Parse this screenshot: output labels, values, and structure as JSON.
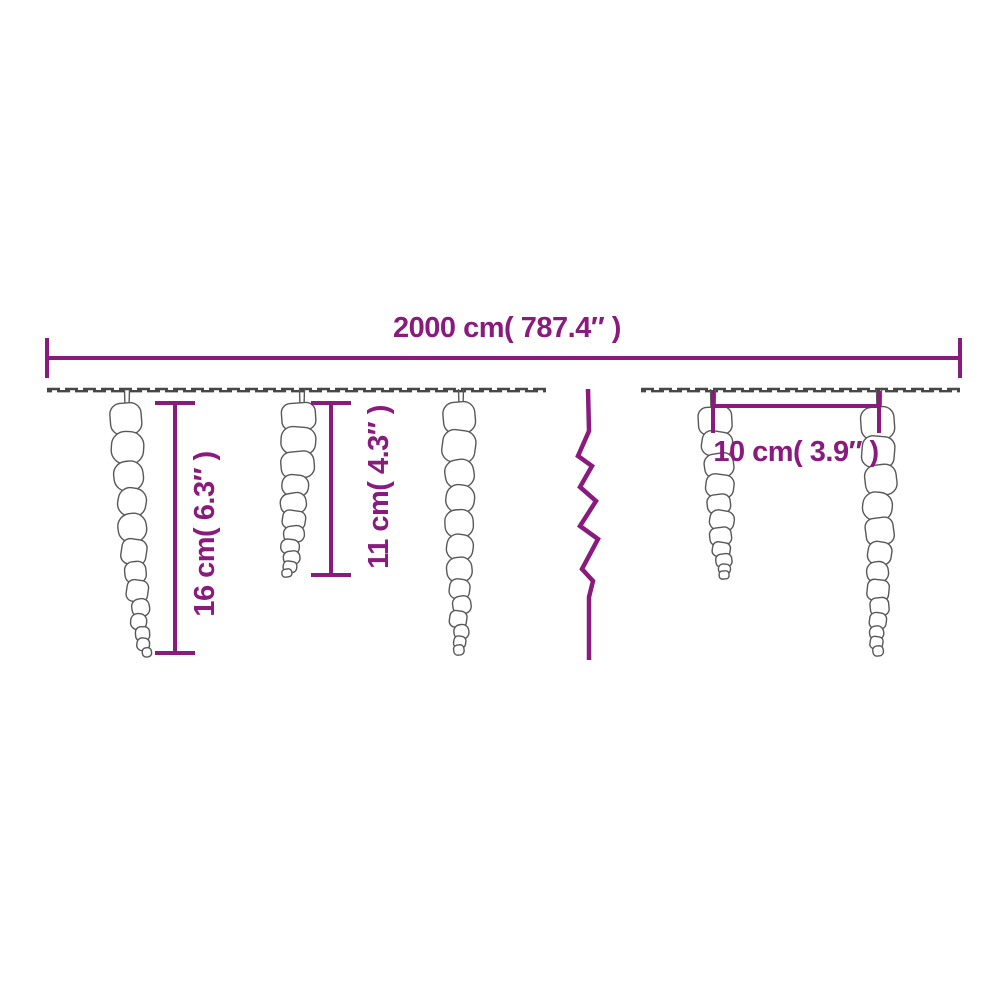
{
  "page": {
    "background": "#ffffff",
    "description": "Product dimension diagram of icicle string lights"
  },
  "colors": {
    "dimension": "#8a1a7d",
    "wire": "#474747",
    "icicle_outline": "#585858",
    "icicle_fill": "#ffffff"
  },
  "labels": {
    "total_width": "2000 cm( 787.4″ )",
    "height_large": "16 cm( 6.3″ )",
    "height_small": "11 cm( 4.3″ )",
    "spacing": "10 cm( 3.9″ )"
  },
  "diagram": {
    "canvas": {
      "width": 1000,
      "height": 1000
    },
    "top_dimension": {
      "x1": 47,
      "x2": 960,
      "y": 358,
      "tick_half": 20,
      "label_anchor": [
        507,
        337
      ]
    },
    "wire": {
      "y": 390,
      "segments": [
        [
          47,
          546
        ],
        [
          641,
          960
        ]
      ]
    },
    "break_line": {
      "points": [
        [
          588,
          389
        ],
        [
          589,
          431
        ],
        [
          578,
          456
        ],
        [
          592,
          466
        ],
        [
          580,
          487
        ],
        [
          596,
          501
        ],
        [
          580,
          526
        ],
        [
          598,
          539
        ],
        [
          582,
          569
        ],
        [
          593,
          581
        ],
        [
          589,
          597
        ],
        [
          589,
          660
        ]
      ]
    },
    "vertical_dimensions": [
      {
        "key": "height_large",
        "x": 175,
        "y1": 403,
        "y2": 653,
        "tick_half": 20,
        "label_anchor": [
          214,
          534
        ]
      },
      {
        "key": "height_small",
        "x": 331,
        "y1": 403,
        "y2": 575,
        "tick_half": 20,
        "label_anchor": [
          388,
          487
        ]
      }
    ],
    "spacing_dimension": {
      "x1": 713,
      "x2": 879,
      "y": 406,
      "tick_y1": 391,
      "tick_y2": 433,
      "label_anchor": [
        796,
        461
      ]
    },
    "icicles": [
      {
        "cx": 127,
        "hanger_x": 127,
        "top": 403,
        "bottom": 657,
        "top_width": 32,
        "tip_width": 10,
        "blobs": 13,
        "drift": 18
      },
      {
        "cx": 300,
        "hanger_x": 302,
        "top": 403,
        "bottom": 577,
        "top_width": 34,
        "tip_width": 10,
        "blobs": 11,
        "drift": -12
      },
      {
        "cx": 460,
        "hanger_x": 461,
        "top": 402,
        "bottom": 655,
        "top_width": 34,
        "tip_width": 10,
        "blobs": 13,
        "drift": 0
      },
      {
        "cx": 717,
        "hanger_x": 713,
        "top": 407,
        "bottom": 579,
        "top_width": 32,
        "tip_width": 10,
        "blobs": 11,
        "drift": 8
      },
      {
        "cx": 879,
        "hanger_x": 879,
        "top": 407,
        "bottom": 656,
        "top_width": 33,
        "tip_width": 10,
        "blobs": 13,
        "drift": -1
      }
    ]
  }
}
